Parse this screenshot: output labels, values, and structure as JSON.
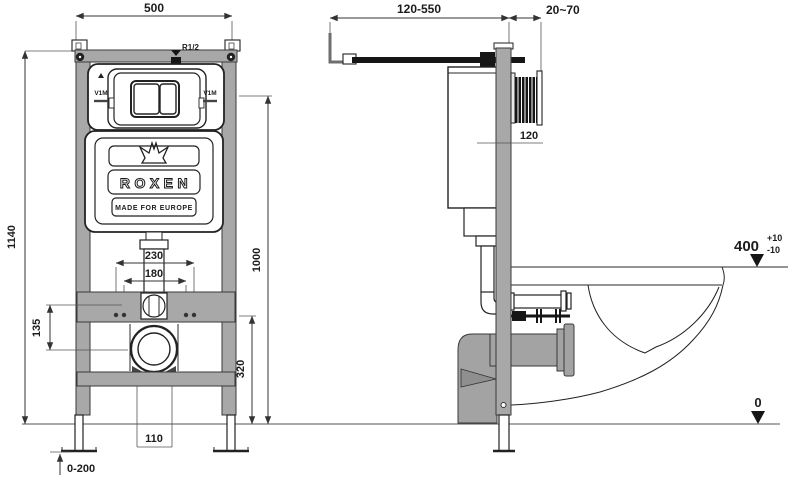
{
  "drawing": {
    "front_view": {
      "dim_width": "500",
      "dim_height": "1140",
      "inlet_label": "R1/2",
      "plate_mark_left": "V1M",
      "plate_mark_right": "V1M",
      "brand": "ROXEN",
      "tagline": "MADE FOR EUROPE",
      "dim_outer_holes": "230",
      "dim_inner_holes": "180",
      "dim_plate_center_height": "1000",
      "dim_stud_to_drain": "135",
      "dim_outlet_height": "320",
      "dim_drain_gap": "110",
      "dim_feet_adjust": "0-200"
    },
    "side_view": {
      "dim_supply_pipe": "120-550",
      "dim_plate_recess": "20~70",
      "dim_frame_depth": "120",
      "dim_rim_height": "400",
      "dim_rim_tol_plus": "+10",
      "dim_rim_tol_minus": "-10",
      "dim_floor_level": "0"
    },
    "colors": {
      "steel_gray": "#a8a8a8",
      "line_black": "#222222"
    }
  }
}
